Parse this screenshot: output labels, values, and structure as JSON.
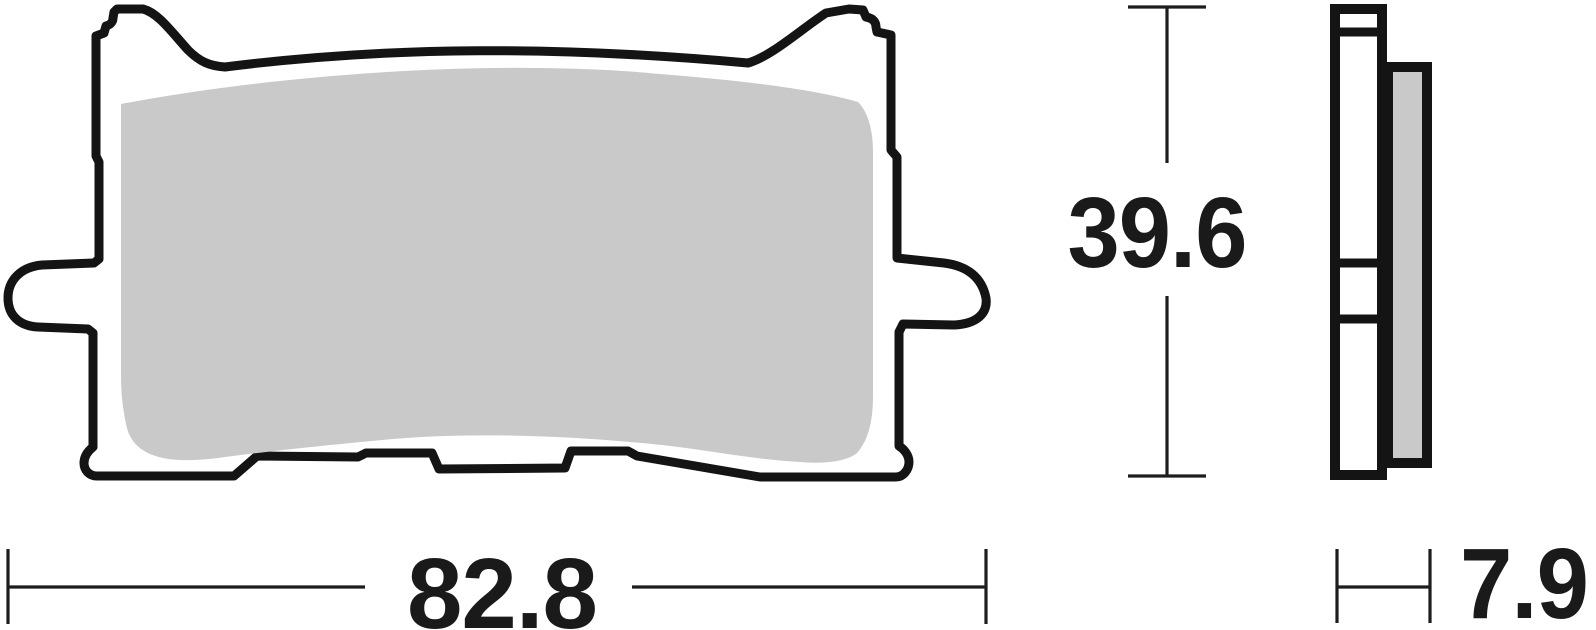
{
  "drawing": {
    "kind": "brake-pad-technical-drawing",
    "dimensions": {
      "width": "82.8",
      "height": "39.6",
      "thickness": "7.9"
    },
    "colors": {
      "background": "#ffffff",
      "outline": "#141414",
      "pad_fill": "#c9c9c9",
      "dimension_line": "#1d1d1d",
      "dimension_text": "#1a1a1a"
    }
  }
}
